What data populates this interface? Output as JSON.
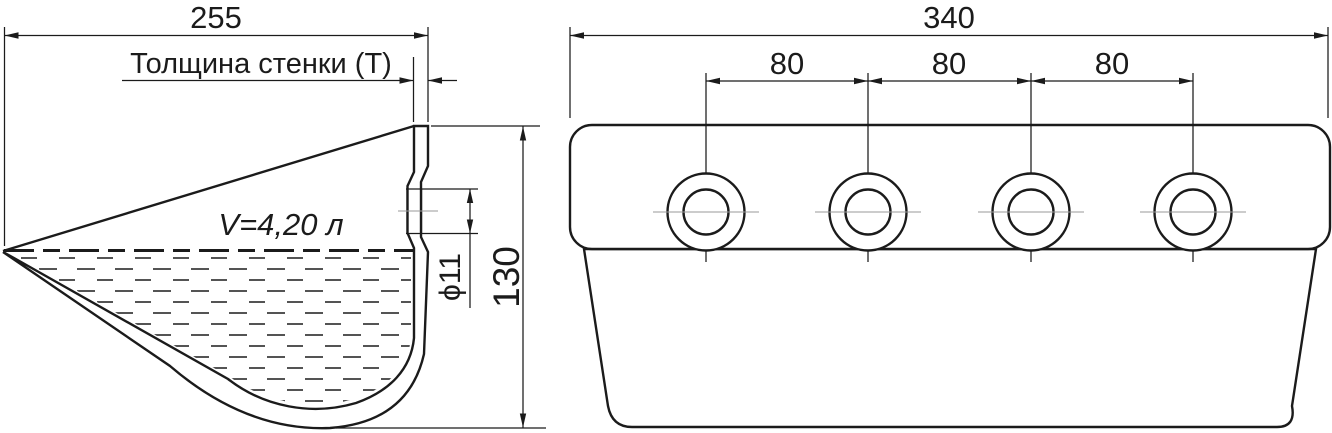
{
  "drawing": {
    "background": "#ffffff",
    "line_color": "#1b1b1b",
    "centerline_color": "#9a9a9a",
    "side_view": {
      "width_dim": "255",
      "wall_thickness_label": "Толщина стенки (Т)",
      "volume_label": "V=4,20 л",
      "hole_diameter_dim": "ϕ11",
      "height_dim": "130"
    },
    "front_view": {
      "width_dim": "340",
      "hole_spacing_dims": [
        "80",
        "80",
        "80"
      ],
      "hole_count": 4
    }
  }
}
